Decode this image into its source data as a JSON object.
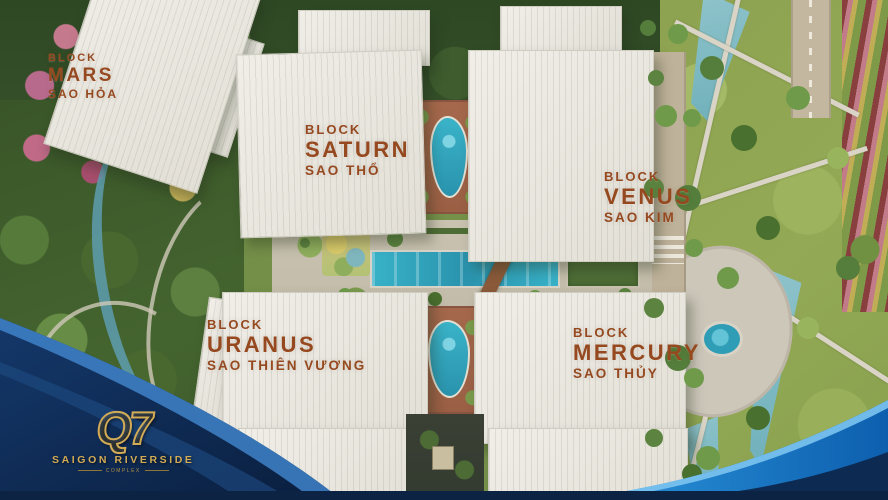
{
  "blocks": [
    {
      "block": "BLOCK",
      "name": "MARS",
      "vietnamese": "SAO HỎA"
    },
    {
      "block": "BLOCK",
      "name": "SATURN",
      "vietnamese": "SAO THỔ"
    },
    {
      "block": "BLOCK",
      "name": "VENUS",
      "vietnamese": "SAO KIM"
    },
    {
      "block": "BLOCK",
      "name": "URANUS",
      "vietnamese": "SAO THIÊN VƯƠNG"
    },
    {
      "block": "BLOCK",
      "name": "MERCURY",
      "vietnamese": "SAO THỦY"
    }
  ],
  "logo": {
    "monogram": "Q7",
    "name": "SAIGON RIVERSIDE",
    "tagline": "COMPLEX"
  },
  "colors": {
    "label_text": "#96491f",
    "pool": "#3ab3c8",
    "navy": "#0d2750",
    "sky_blue": "#1878ce",
    "gold": "#d2ab56",
    "building_roof": "#ece9e2",
    "lawn": "#8ea350",
    "forest": "#3a5629",
    "terracotta_deck": "#a5684c"
  }
}
